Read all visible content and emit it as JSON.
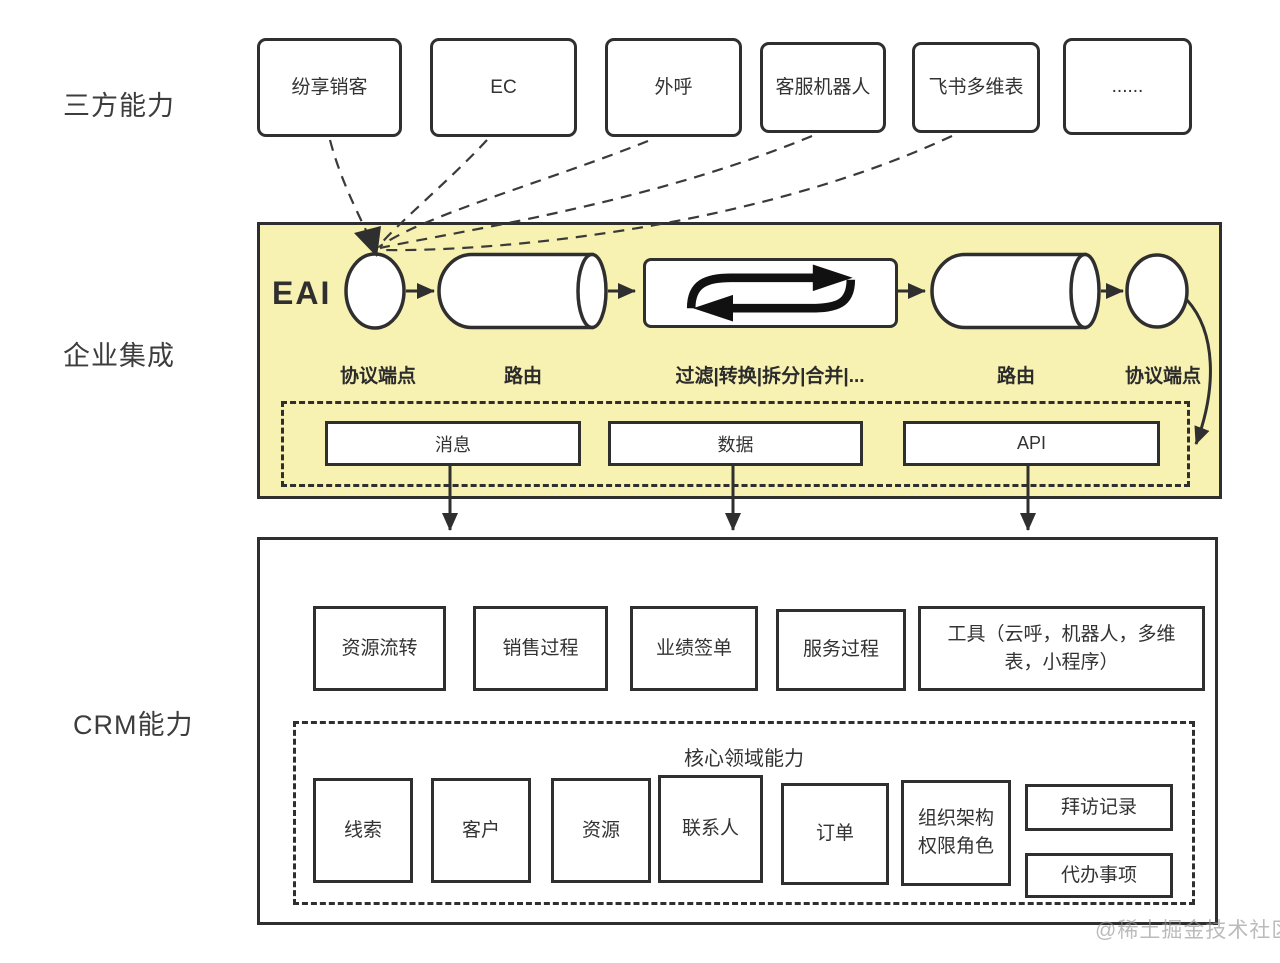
{
  "section_labels": {
    "third_party": "三方能力",
    "integration": "企业集成",
    "crm": "CRM能力"
  },
  "third_party": {
    "items": [
      {
        "label": "纷享销客"
      },
      {
        "label": "EC"
      },
      {
        "label": "外呼"
      },
      {
        "label": "客服机器人"
      },
      {
        "label": "飞书多维表"
      },
      {
        "label": "......"
      }
    ]
  },
  "eai": {
    "title": "EAI",
    "stage_labels": [
      {
        "label": "协议端点"
      },
      {
        "label": "路由"
      },
      {
        "label": "过滤|转换|拆分|合并|..."
      },
      {
        "label": "路由"
      },
      {
        "label": "协议端点"
      }
    ],
    "channels": [
      {
        "label": "消息"
      },
      {
        "label": "数据"
      },
      {
        "label": "API"
      }
    ]
  },
  "crm": {
    "modules": [
      {
        "label": "资源流转"
      },
      {
        "label": "销售过程"
      },
      {
        "label": "业绩签单"
      },
      {
        "label": "服务过程"
      },
      {
        "label": "工具（云呼，机器人，多维表，小程序）"
      }
    ],
    "core": {
      "title": "核心领域能力",
      "items": [
        {
          "label": "线索"
        },
        {
          "label": "客户"
        },
        {
          "label": "资源"
        },
        {
          "label": "联系人"
        },
        {
          "label": "订单"
        },
        {
          "label": "组织架构权限角色"
        },
        {
          "label": "拜访记录"
        },
        {
          "label": "代办事项"
        }
      ]
    }
  },
  "watermark": "@稀土掘金技术社区",
  "colors": {
    "panel_fill": "#F7F1B2",
    "border": "#2F2F2F",
    "watermark": "#BDBDBD",
    "background": "#FFFFFF"
  }
}
